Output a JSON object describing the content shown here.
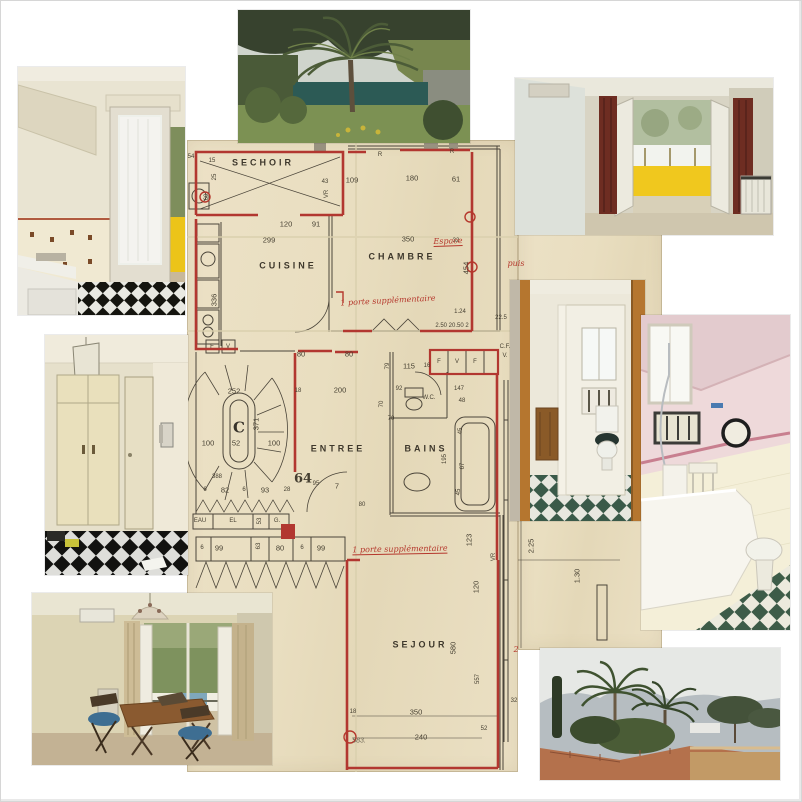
{
  "palette": {
    "paper": "#e9dec0",
    "wall_red": "#b23730",
    "ink": "#4b453a",
    "annotation_red": "#b5372c",
    "crease": "#d9cfad",
    "checker_dark": "#15150f",
    "checker_green": "#3c5b49",
    "balustrade_yellow": "#f0c81e",
    "curtain_red": "#6e2d22"
  },
  "plan": {
    "labels": [
      {
        "t": "SECHOIR",
        "x": 263,
        "y": 163,
        "c": "room"
      },
      {
        "t": "CUISINE",
        "x": 288,
        "y": 266,
        "c": "room"
      },
      {
        "t": "CHAMBRE",
        "x": 402,
        "y": 257,
        "c": "room"
      },
      {
        "t": "ENTREE",
        "x": 338,
        "y": 449,
        "c": "room"
      },
      {
        "t": "BAINS",
        "x": 426,
        "y": 449,
        "c": "room"
      },
      {
        "t": "W.C.",
        "x": 429,
        "y": 398,
        "c": "tiny"
      },
      {
        "t": "SEJOUR",
        "x": 420,
        "y": 645,
        "c": "room"
      },
      {
        "t": "54",
        "x": 191,
        "y": 157,
        "c": "tiny"
      },
      {
        "t": "15",
        "x": 212,
        "y": 161,
        "c": "tiny"
      },
      {
        "t": "25",
        "x": 215,
        "y": 177,
        "c": "tiny",
        "r": -90
      },
      {
        "t": "60",
        "x": 207,
        "y": 197,
        "c": "tiny",
        "r": -90
      },
      {
        "t": "VR",
        "x": 327,
        "y": 194,
        "c": "tiny",
        "r": -90
      },
      {
        "t": "43",
        "x": 325,
        "y": 182,
        "c": "tiny"
      },
      {
        "t": "109",
        "x": 352,
        "y": 180,
        "c": "dim"
      },
      {
        "t": "180",
        "x": 412,
        "y": 178,
        "c": "dim"
      },
      {
        "t": "61",
        "x": 456,
        "y": 179,
        "c": "dim"
      },
      {
        "t": "R",
        "x": 380,
        "y": 155,
        "c": "tiny"
      },
      {
        "t": "R",
        "x": 452,
        "y": 152,
        "c": "tiny"
      },
      {
        "t": "120",
        "x": 286,
        "y": 224,
        "c": "dim"
      },
      {
        "t": "91",
        "x": 316,
        "y": 224,
        "c": "dim"
      },
      {
        "t": "299",
        "x": 269,
        "y": 240,
        "c": "dim"
      },
      {
        "t": "350",
        "x": 408,
        "y": 239,
        "c": "dim"
      },
      {
        "t": "32",
        "x": 456,
        "y": 241,
        "c": "tiny"
      },
      {
        "t": "454",
        "x": 466,
        "y": 268,
        "c": "dim",
        "r": -90
      },
      {
        "t": "336",
        "x": 214,
        "y": 300,
        "c": "dim",
        "r": -90
      },
      {
        "t": "1.24",
        "x": 460,
        "y": 312,
        "c": "tiny"
      },
      {
        "t": "2.50  20.50  2",
        "x": 452,
        "y": 326,
        "c": "tiny"
      },
      {
        "t": "22.5",
        "x": 501,
        "y": 318,
        "c": "tiny"
      },
      {
        "t": "C.F.",
        "x": 505,
        "y": 347,
        "c": "tiny"
      },
      {
        "t": "V.",
        "x": 505,
        "y": 356,
        "c": "tiny"
      },
      {
        "t": "80",
        "x": 301,
        "y": 354,
        "c": "dim"
      },
      {
        "t": "80",
        "x": 349,
        "y": 354,
        "c": "dim"
      },
      {
        "t": "F",
        "x": 439,
        "y": 362,
        "c": "tiny"
      },
      {
        "t": "V",
        "x": 457,
        "y": 362,
        "c": "tiny"
      },
      {
        "t": "F",
        "x": 475,
        "y": 362,
        "c": "tiny"
      },
      {
        "t": "F",
        "x": 212,
        "y": 347,
        "c": "tiny"
      },
      {
        "t": "V",
        "x": 228,
        "y": 347,
        "c": "tiny"
      },
      {
        "t": "79",
        "x": 388,
        "y": 366,
        "c": "tiny",
        "r": -90
      },
      {
        "t": "115",
        "x": 409,
        "y": 366,
        "c": "dim"
      },
      {
        "t": "16",
        "x": 427,
        "y": 366,
        "c": "tiny"
      },
      {
        "t": "252",
        "x": 234,
        "y": 391,
        "c": "dim"
      },
      {
        "t": "18",
        "x": 298,
        "y": 391,
        "c": "tiny"
      },
      {
        "t": "200",
        "x": 340,
        "y": 390,
        "c": "dim"
      },
      {
        "t": "92",
        "x": 399,
        "y": 389,
        "c": "tiny"
      },
      {
        "t": "147",
        "x": 459,
        "y": 389,
        "c": "tiny"
      },
      {
        "t": "70",
        "x": 382,
        "y": 404,
        "c": "tiny",
        "r": -90
      },
      {
        "t": "70",
        "x": 391,
        "y": 419,
        "c": "tiny"
      },
      {
        "t": "48",
        "x": 462,
        "y": 401,
        "c": "tiny"
      },
      {
        "t": "C",
        "x": 239,
        "y": 428,
        "c": "stair"
      },
      {
        "t": "371",
        "x": 256,
        "y": 424,
        "c": "dim",
        "r": -90
      },
      {
        "t": "100",
        "x": 208,
        "y": 443,
        "c": "dim"
      },
      {
        "t": "52",
        "x": 236,
        "y": 443,
        "c": "dim"
      },
      {
        "t": "100",
        "x": 274,
        "y": 443,
        "c": "dim"
      },
      {
        "t": "195",
        "x": 445,
        "y": 459,
        "c": "tiny",
        "r": -90
      },
      {
        "t": "45",
        "x": 461,
        "y": 431,
        "c": "tiny",
        "r": -90
      },
      {
        "t": "67",
        "x": 463,
        "y": 466,
        "c": "tiny",
        "r": -90
      },
      {
        "t": "45",
        "x": 459,
        "y": 492,
        "c": "tiny",
        "r": -90
      },
      {
        "t": "388",
        "x": 217,
        "y": 477,
        "c": "tiny"
      },
      {
        "t": "6",
        "x": 205,
        "y": 490,
        "c": "tiny"
      },
      {
        "t": "82",
        "x": 225,
        "y": 490,
        "c": "dim"
      },
      {
        "t": "6",
        "x": 244,
        "y": 490,
        "c": "tiny"
      },
      {
        "t": "93",
        "x": 265,
        "y": 490,
        "c": "dim"
      },
      {
        "t": "28",
        "x": 287,
        "y": 490,
        "c": "tiny"
      },
      {
        "t": "64",
        "x": 303,
        "y": 479,
        "c": "big"
      },
      {
        "t": "95",
        "x": 316,
        "y": 484,
        "c": "tiny"
      },
      {
        "t": "7",
        "x": 337,
        "y": 486,
        "c": "dim"
      },
      {
        "t": "80",
        "x": 362,
        "y": 505,
        "c": "tiny"
      },
      {
        "t": "EAU",
        "x": 200,
        "y": 521,
        "c": "tiny"
      },
      {
        "t": "EL",
        "x": 233,
        "y": 521,
        "c": "tiny"
      },
      {
        "t": "53",
        "x": 260,
        "y": 521,
        "c": "tiny",
        "r": -90
      },
      {
        "t": "G.",
        "x": 277,
        "y": 521,
        "c": "tiny"
      },
      {
        "t": "6",
        "x": 202,
        "y": 548,
        "c": "tiny"
      },
      {
        "t": "99",
        "x": 219,
        "y": 548,
        "c": "dim"
      },
      {
        "t": "63",
        "x": 259,
        "y": 546,
        "c": "tiny",
        "r": -90
      },
      {
        "t": "80",
        "x": 280,
        "y": 548,
        "c": "dim"
      },
      {
        "t": "6",
        "x": 302,
        "y": 548,
        "c": "tiny"
      },
      {
        "t": "99",
        "x": 321,
        "y": 548,
        "c": "dim"
      },
      {
        "t": "123",
        "x": 469,
        "y": 540,
        "c": "dim",
        "r": -90
      },
      {
        "t": "VR",
        "x": 494,
        "y": 557,
        "c": "tiny",
        "r": -90
      },
      {
        "t": "120",
        "x": 476,
        "y": 587,
        "c": "dim",
        "r": -90
      },
      {
        "t": "2.25",
        "x": 531,
        "y": 546,
        "c": "dim",
        "r": -90
      },
      {
        "t": "1.30",
        "x": 577,
        "y": 576,
        "c": "dim",
        "r": -90
      },
      {
        "t": "580",
        "x": 453,
        "y": 648,
        "c": "dim",
        "r": -90
      },
      {
        "t": "557",
        "x": 478,
        "y": 679,
        "c": "tiny",
        "r": -90
      },
      {
        "t": "350",
        "x": 416,
        "y": 712,
        "c": "dim"
      },
      {
        "t": "18",
        "x": 353,
        "y": 712,
        "c": "tiny"
      },
      {
        "t": "240",
        "x": 421,
        "y": 737,
        "c": "dim"
      },
      {
        "t": "52",
        "x": 484,
        "y": 729,
        "c": "tiny"
      },
      {
        "t": "32",
        "x": 514,
        "y": 701,
        "c": "tiny"
      },
      {
        "t": "583.",
        "x": 359,
        "y": 741,
        "c": "pencil"
      },
      {
        "t": "1 porte supplémentaire",
        "x": 388,
        "y": 301,
        "c": "red",
        "r": -3
      },
      {
        "t": "Espace",
        "x": 448,
        "y": 242,
        "c": "redu",
        "r": -2
      },
      {
        "t": "puis",
        "x": 516,
        "y": 264,
        "c": "red"
      },
      {
        "t": "1 porte supplémentaire",
        "x": 400,
        "y": 550,
        "c": "redu",
        "r": -1
      },
      {
        "t": "2",
        "x": 516,
        "y": 650,
        "c": "red"
      }
    ]
  }
}
